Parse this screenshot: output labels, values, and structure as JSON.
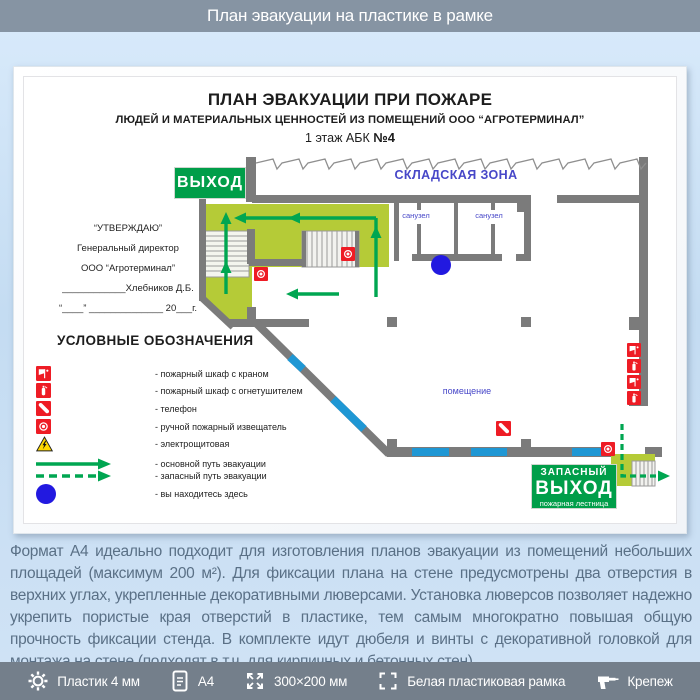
{
  "header": {
    "title": "План эвакуации на пластике в рамке"
  },
  "plan": {
    "title": "ПЛАН ЭВАКУАЦИИ ПРИ ПОЖАРЕ",
    "subtitle": "ЛЮДЕЙ И МАТЕРИАЛЬНЫХ ЦЕННОСТЕЙ ИЗ ПОМЕЩЕНИЙ ООО “АГРОТЕРМИНАЛ”",
    "floor_line_pre": "1 этаж АБК ",
    "floor_line_num": "№4",
    "exit_sign": "ВЫХОД",
    "reserve_exit": {
      "line1": "ЗАПАСНЫЙ",
      "line2": "ВЫХОД",
      "line3": "пожарная лестница"
    },
    "labels": {
      "storage_zone": "СКЛАДСКАЯ ЗОНА",
      "bathroom1": "санузел",
      "bathroom2": "санузел",
      "room": "помещение"
    },
    "approval": {
      "line1": "“УТВЕРЖДАЮ”",
      "line2": "Генеральный директор",
      "line3": "ООО “Агротерминал”",
      "line4": "____________Хлебников Д.Б.",
      "line5": "“____” ______________ 20___г."
    },
    "legend": {
      "title": "УСЛОВНЫЕ ОБОЗНАЧЕНИЯ",
      "items": [
        {
          "icon": "fire-cabinet-crane-icon",
          "label": "- пожарный шкаф с краном"
        },
        {
          "icon": "fire-cabinet-extinguisher-icon",
          "label": "- пожарный шкаф с огнетушителем"
        },
        {
          "icon": "phone-icon",
          "label": "- телефон"
        },
        {
          "icon": "manual-call-point-icon",
          "label": "- ручной пожарный извещатель"
        },
        {
          "icon": "electrical-room-icon",
          "label": "- электрощитовая"
        },
        {
          "icon": "main-route-arrow-icon",
          "label": "- основной путь эвакуации"
        },
        {
          "icon": "reserve-route-arrow-icon",
          "label": "- запасный путь эвакуации"
        },
        {
          "icon": "you-are-here-icon",
          "label": "- вы находитесь здесь"
        }
      ]
    }
  },
  "description": "Формат А4 идеально подходит для изготовления планов эвакуации из помещений небольших площадей (максимум 200 м²). Для фиксации плана на стене предусмотрены два отверстия в верхних углах, укрепленные декоративными люверсами. Установка люверсов позволяет надежно укрепить пористые края отверстий в пластике, тем самым многократно повышая общую прочность фиксации стенда. В комплекте идут дюбеля и винты с декоративной головкой для монтажа на стене (подходят в т.ч. для кирпичных и бетонных стен)",
  "features": [
    {
      "icon": "gear-icon",
      "label": "Пластик 4 мм"
    },
    {
      "icon": "document-icon",
      "label": "А4"
    },
    {
      "icon": "dimensions-icon",
      "label": "300×200 мм"
    },
    {
      "icon": "frame-icon",
      "label": "Белая пластиковая рамка"
    },
    {
      "icon": "drill-icon",
      "label": "Крепеж"
    }
  ],
  "colors": {
    "header_bg": "#8694a3",
    "footer_bg": "#747f8b",
    "backdrop": "#c9def2",
    "wall_gray": "#7b7b7b",
    "zone_green": "#b5cb37",
    "sign_green": "#009e49",
    "route_green": "#00a651",
    "alarm_red": "#ee1c25",
    "window_blue": "#1f97d4",
    "marker_blue": "#2219e0",
    "label_blue": "#4747c8",
    "warning_yellow": "#ffd800",
    "description_text": "#5a7086"
  }
}
